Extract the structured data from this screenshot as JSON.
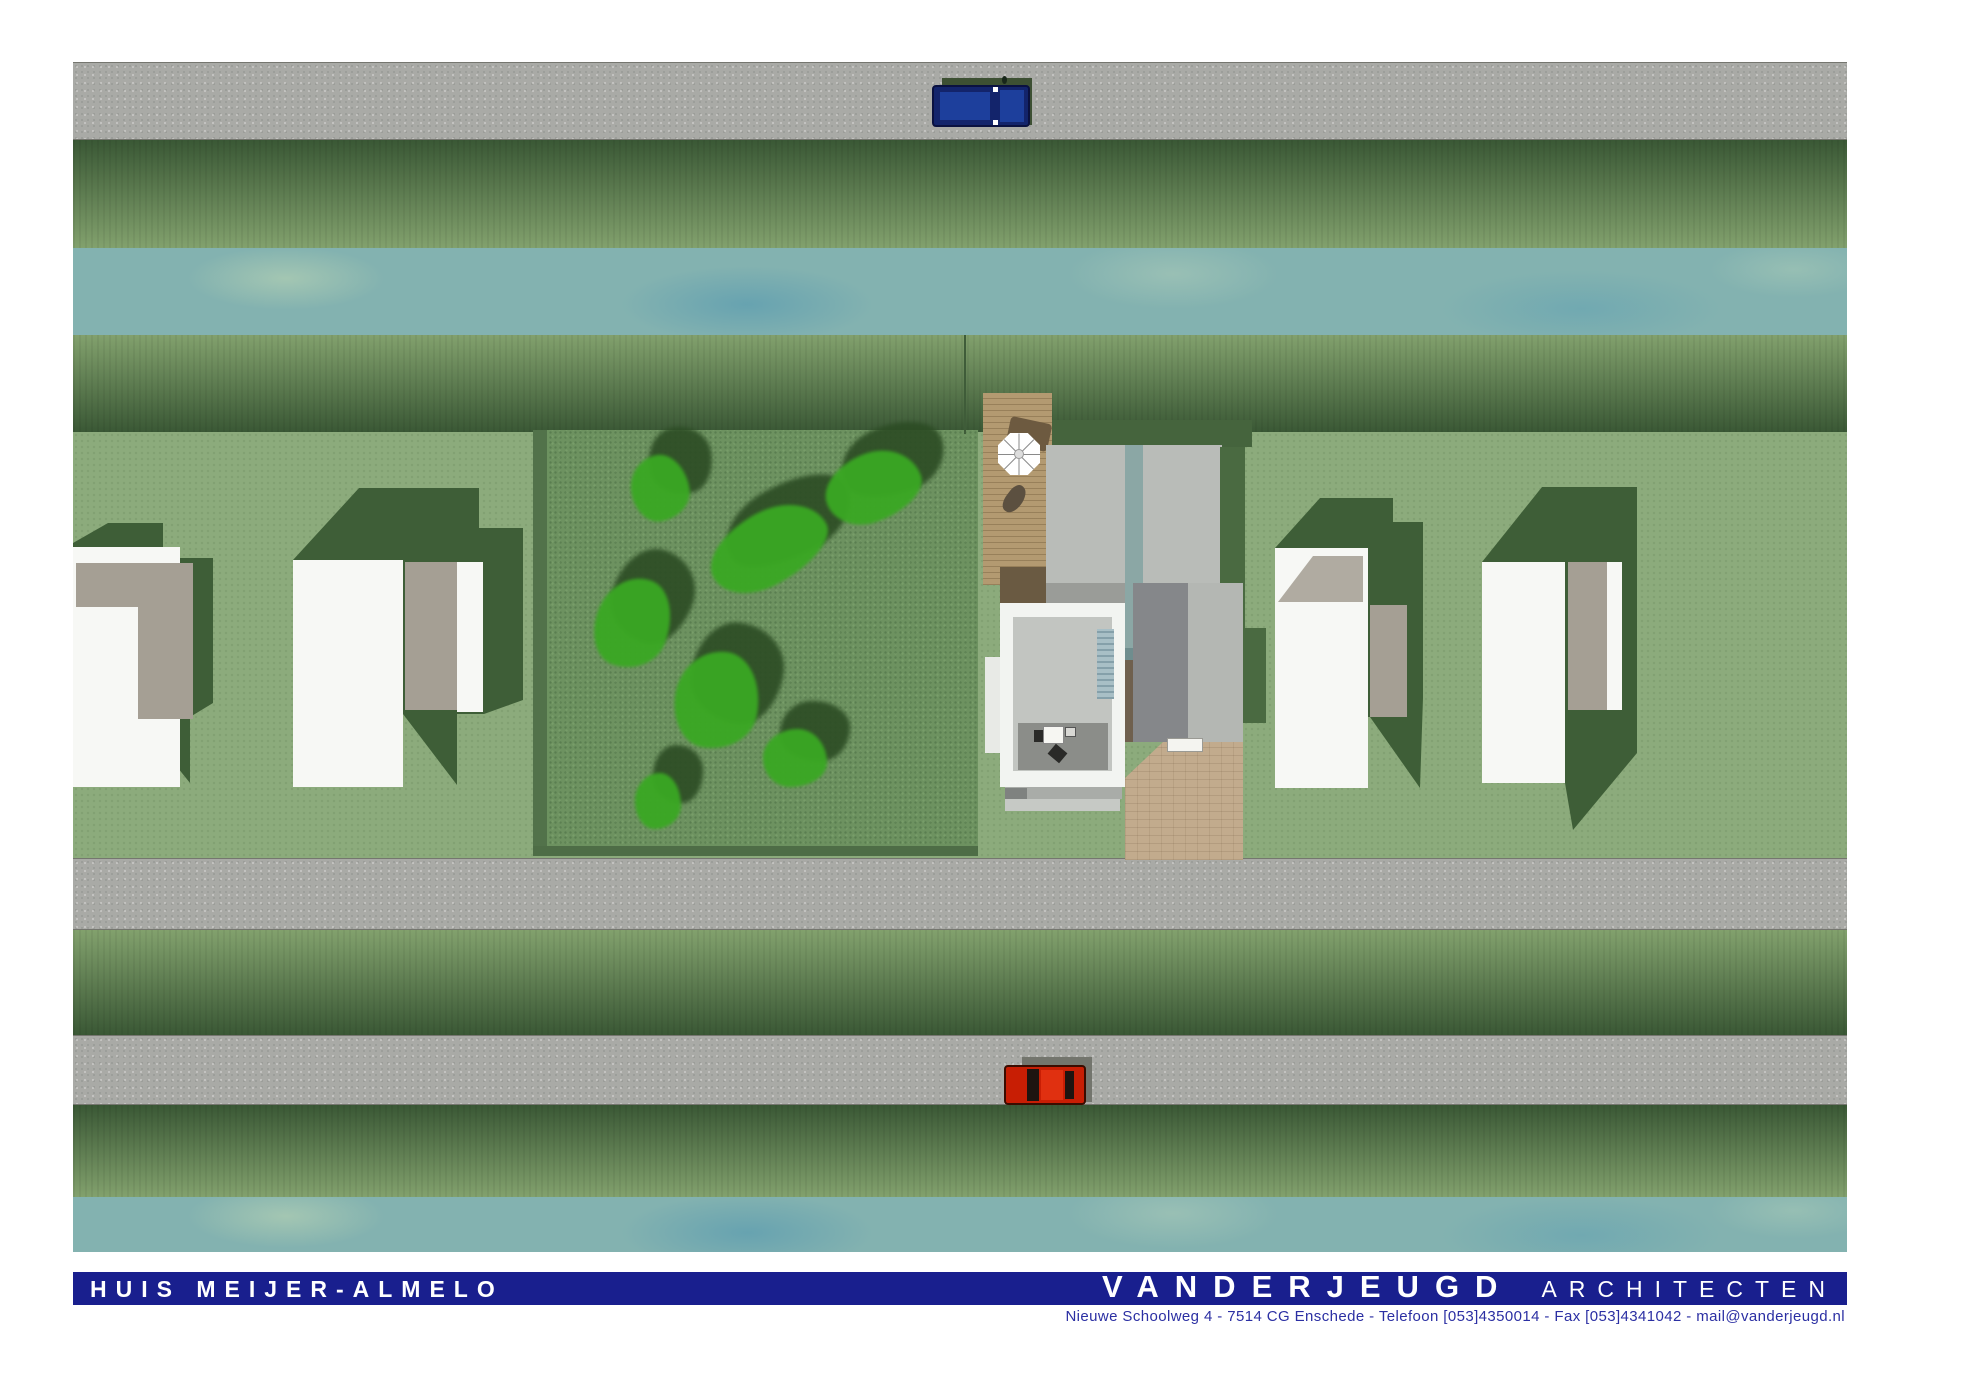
{
  "document": {
    "project_title": "HUIS MEIJER-ALMELO",
    "firm_name": "VANDERJEUGD",
    "firm_type": "ARCHITECTEN",
    "address_line": "Nieuwe Schoolweg 4  - 7514 CG Enschede  - Telefoon [053]4350014  -  Fax [053]4341042  -  mail@vanderjeugd.nl"
  },
  "palette": {
    "title_bar_blue": "#191f8e",
    "address_text_blue": "#2b2fa3",
    "road_gray": "#a9aaa6",
    "hedge_dark_green": "#3a5835",
    "hedge_light_green": "#82a16d",
    "water_teal": "#7fb0b2",
    "grass_green": "#8cab7c",
    "garden_green": "#6d9260",
    "tree_bright_green": "#3aa823",
    "tree_shadow_green": "#2c4c24",
    "house_white": "#f7f8f5",
    "house_taupe": "#a59f94",
    "house_shadow_green": "#3e5e37",
    "deck_wood": "#b39a71",
    "driveway_beige": "#c2ab8d",
    "car_blue": "#1d3f9c",
    "car_red": "#c81e04"
  },
  "scene": {
    "bands": [
      {
        "name": "road-north",
        "cls": "road",
        "y": 0,
        "h": 78
      },
      {
        "name": "hedge-north-outer",
        "cls": "hedge-dtl",
        "y": 78,
        "h": 108
      },
      {
        "name": "canal-north",
        "cls": "water",
        "y": 186,
        "h": 87
      },
      {
        "name": "hedge-north-inner",
        "cls": "hedge-ltd",
        "y": 273,
        "h": 97
      },
      {
        "name": "grass-main",
        "cls": "grass",
        "y": 370,
        "h": 426
      },
      {
        "name": "road-middle",
        "cls": "road",
        "y": 796,
        "h": 72
      },
      {
        "name": "hedge-middle",
        "cls": "hedge-ltd",
        "y": 868,
        "h": 105
      },
      {
        "name": "road-south",
        "cls": "road",
        "y": 973,
        "h": 70
      },
      {
        "name": "hedge-south",
        "cls": "hedge-dtl",
        "y": 1043,
        "h": 92
      },
      {
        "name": "canal-south",
        "cls": "water",
        "y": 1135,
        "h": 55
      }
    ],
    "trees": [
      {
        "x": 587,
        "y": 426,
        "w": 58,
        "h": 66,
        "rot": -10
      },
      {
        "x": 695,
        "y": 486,
        "w": 125,
        "h": 72,
        "rot": -28
      },
      {
        "x": 800,
        "y": 425,
        "w": 98,
        "h": 68,
        "rot": -20
      },
      {
        "x": 560,
        "y": 561,
        "w": 74,
        "h": 92,
        "rot": 20
      },
      {
        "x": 644,
        "y": 638,
        "w": 84,
        "h": 98,
        "rot": 10
      },
      {
        "x": 722,
        "y": 696,
        "w": 64,
        "h": 58,
        "rot": 0
      },
      {
        "x": 585,
        "y": 739,
        "w": 46,
        "h": 56,
        "rot": 0
      }
    ]
  }
}
